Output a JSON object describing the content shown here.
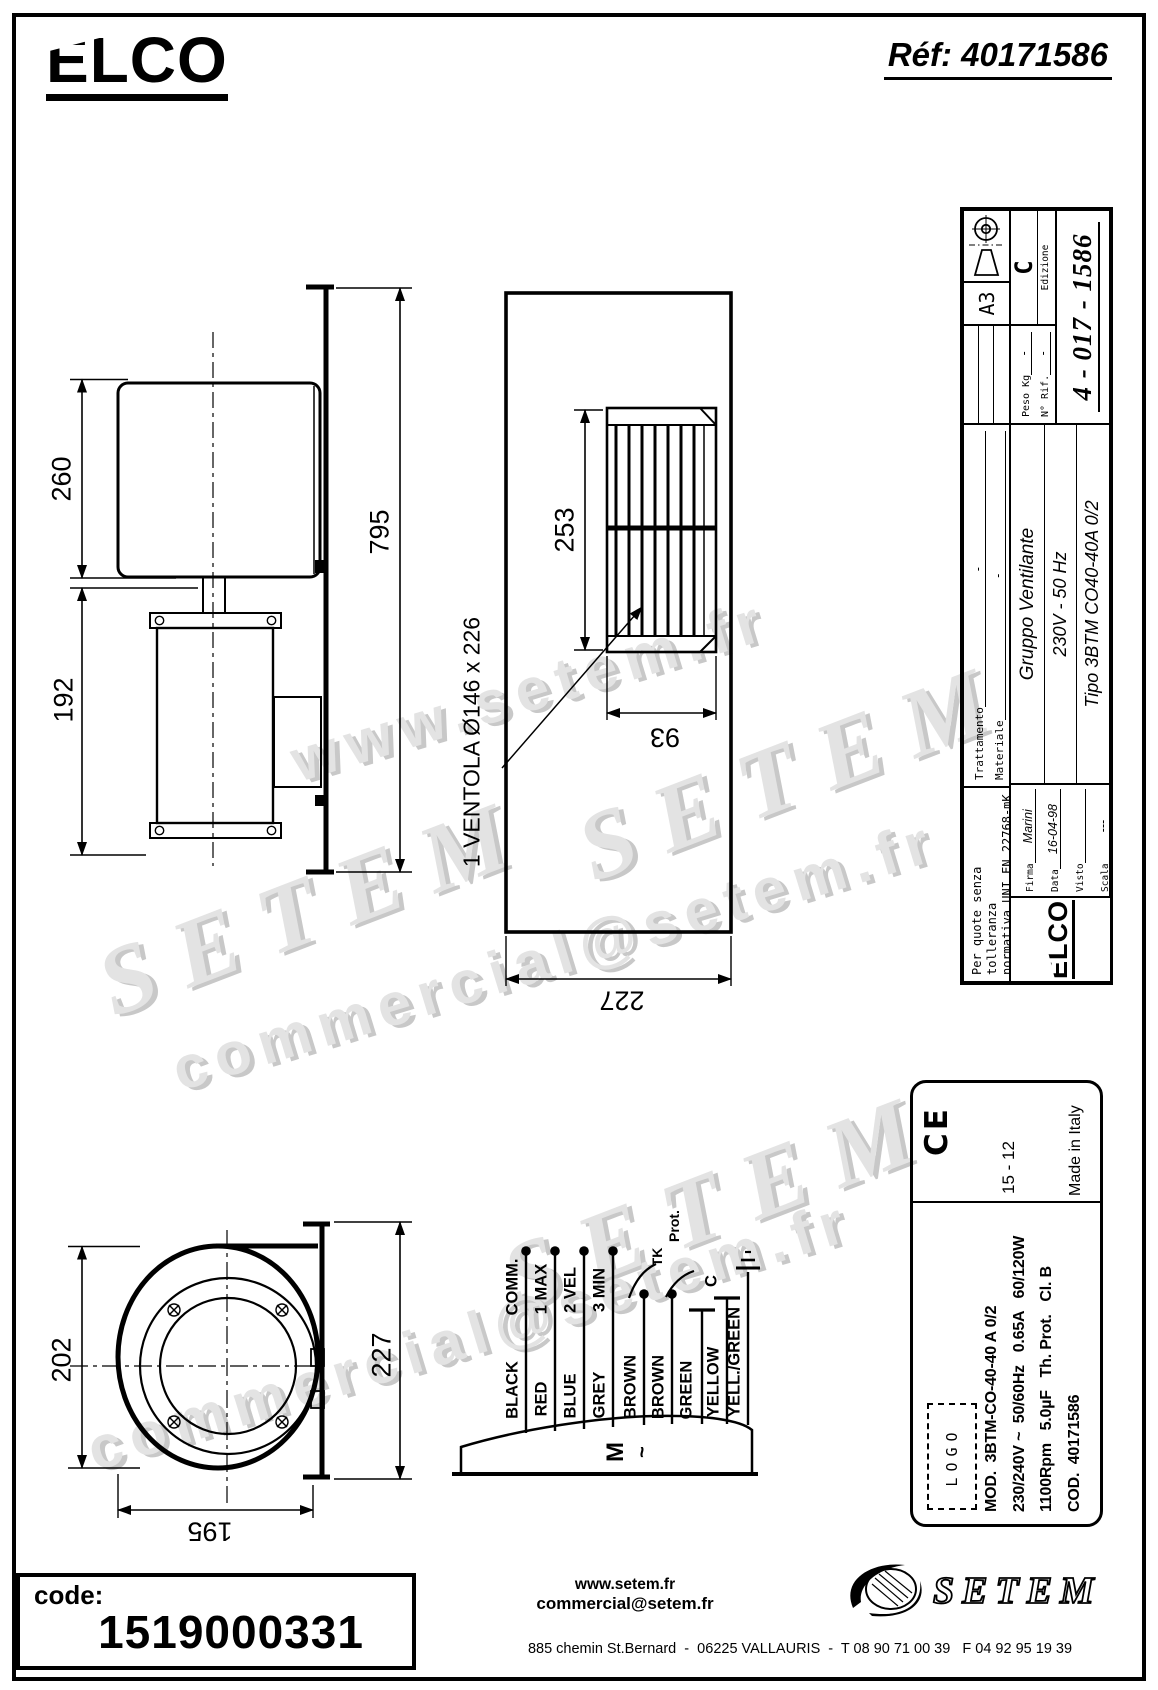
{
  "page": {
    "brand": "ELCO",
    "ref": "Réf: 40171586"
  },
  "watermarks": {
    "w1": "www.setem.fr",
    "w2": "SETEM",
    "w3": "SETEM",
    "w4": "commercial@setem.fr",
    "w5": "SETEM",
    "w6": "commercial@setem.fr"
  },
  "drawings": {
    "side_view": {
      "dim_housing": "260",
      "dim_motor": "192",
      "dim_total": "795"
    },
    "front_view": {
      "dim_grille_height": "253",
      "dim_grille_width": "93",
      "dim_width": "227",
      "fan_note": "1 VENTOLA Ø146 x 226"
    },
    "top_view": {
      "dim_depth": "202",
      "dim_height": "227",
      "dim_width": "195"
    }
  },
  "wiring": {
    "wires": [
      {
        "color": "BLACK",
        "function": "COMM."
      },
      {
        "color": "RED",
        "function": "1 MAX"
      },
      {
        "color": "BLUE",
        "function": "2 VEL"
      },
      {
        "color": "GREY",
        "function": "3 MIN"
      },
      {
        "color": "BROWN",
        "function": ""
      },
      {
        "color": "BROWN",
        "function": ""
      },
      {
        "color": "GREEN",
        "function": ""
      },
      {
        "color": "YELLOW",
        "function": ""
      },
      {
        "color": "YELL./GREEN",
        "function": ""
      }
    ],
    "tk": "TK",
    "prot": "Prot.",
    "cap": "C",
    "motor": "M",
    "phase": "~"
  },
  "title_block": {
    "tolerance1": "Per quote senza tolleranza",
    "tolerance2": "normativa UNI EN 22768-mK",
    "trattamento_label": "Trattamento",
    "trattamento_value": "-",
    "materiale_label": "Materiale",
    "materiale_value": "-",
    "format": "A3",
    "edizione_label": "Edizione",
    "edizione_value": "C",
    "brand": "ELCO",
    "firma_label": "Firma",
    "firma_value": "Marini",
    "data_label": "Data",
    "data_value": "16-04-98",
    "visto_label": "Visto",
    "visto_value": "",
    "scala_label": "Scala",
    "scala_value": "---",
    "title1": "Gruppo Ventilante",
    "title2": "230V - 50 Hz",
    "title3": "Tipo 3BTM CO40-40A 0/2",
    "peso_label": "Peso Kg",
    "peso_value": "-",
    "rif_label": "N° Rif.",
    "rif_value": "-",
    "number": "4 - 017 - 1586"
  },
  "label_block": {
    "ce_mark": "CE",
    "date_code": "15 - 12",
    "made_in": "Made in Italy",
    "logo_placeholder": "LOGO",
    "line1": "MOD.  3BTM-CO-40-40 A 0/2",
    "line2": "230/240V ~  50/60Hz   0.65A   60/120W",
    "line3": "1100Rpm   5.0µF   Th. Prot.   Cl. B",
    "line4": "COD.  40171586"
  },
  "footer": {
    "code_label": "code:",
    "code_value": "1519000331",
    "website": "www.setem.fr",
    "email": "commercial@setem.fr",
    "address": "885 chemin St.Bernard  -  06225 VALLAURIS  -  T 08 90 71 00 39   F 04 92 95 19 39",
    "brand": "SETEM"
  }
}
